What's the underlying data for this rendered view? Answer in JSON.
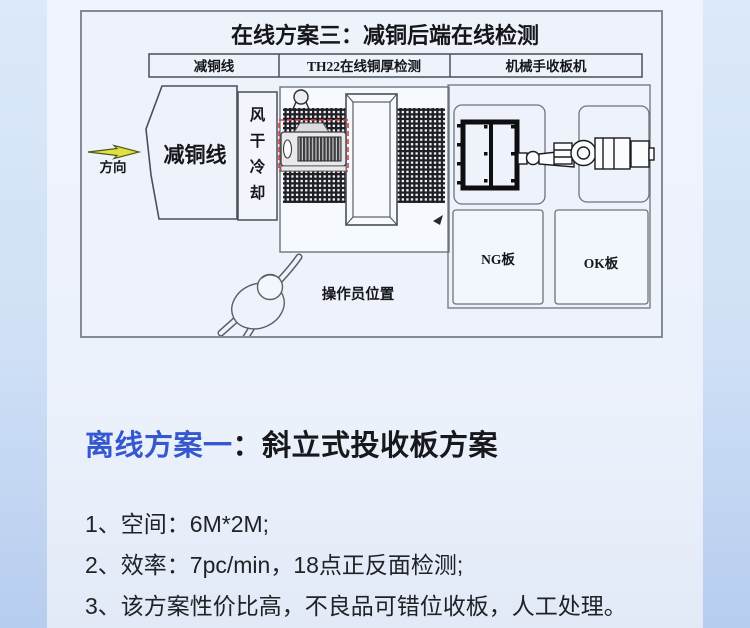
{
  "diagram": {
    "title": "在线方案三：减铜后端在线检测",
    "lane_headers": [
      "减铜线",
      "TH22在线铜厚检测",
      "机械手收板机"
    ],
    "direction_label": "方向",
    "copper_line_label": "减铜线",
    "air_dry_chars": [
      "风",
      "干",
      "冷",
      "却"
    ],
    "ng_label": "NG板",
    "ok_label": "OK板",
    "operator_label": "操作员位置"
  },
  "heading": {
    "highlight": "离线方案一",
    "separator": "：",
    "rest": "斜立式投收板方案"
  },
  "list_items": [
    "1、空间：6M*2M;",
    "2、效率：7pc/min，18点正反面检测;",
    "3、该方案性价比高，不良品可错位收板，人工处理。"
  ],
  "colors": {
    "accent_blue": "#3558cf",
    "arrow_yellow": "#dde23f",
    "dash_red": "#e03c3c"
  }
}
